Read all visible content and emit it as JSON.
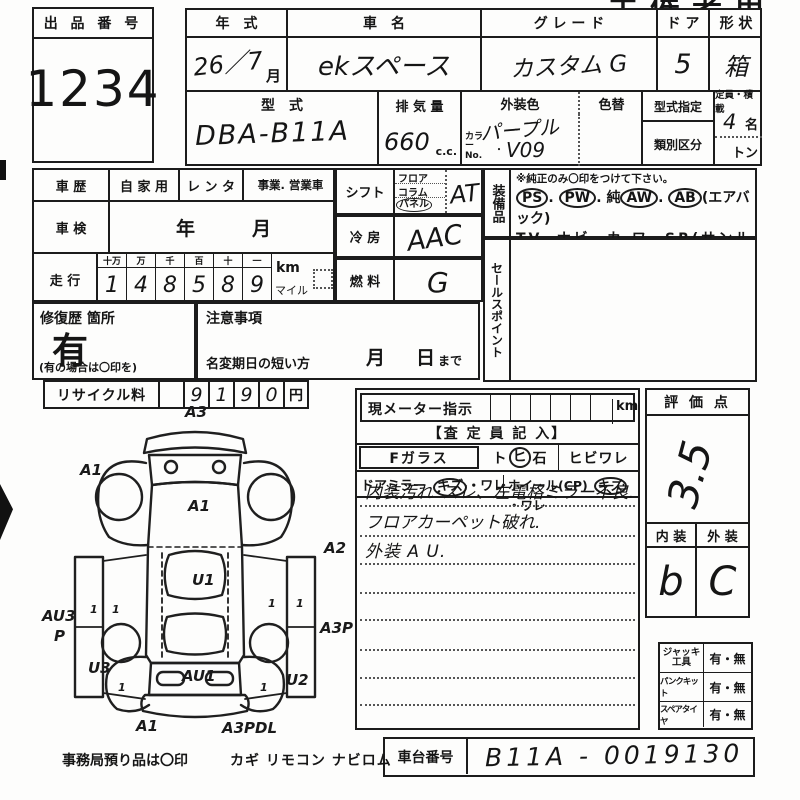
{
  "sheet": {
    "corner_title": "主催者用"
  },
  "auction": {
    "label": "出 品 番 号",
    "number": "1234"
  },
  "vehicle": {
    "year_label": "年　式",
    "year_value": "26／7",
    "month_suffix": "月",
    "name_label": "車　名",
    "name_value": "ekスペース",
    "grade_label": "グ レ ー ド",
    "grade_value": "カスタム G",
    "door_label": "ド ア",
    "door_value": "5",
    "shape_label": "形 状",
    "shape_value": "箱",
    "model_label": "型　式",
    "model_value": "DBA-B11A",
    "disp_label": "排 気 量",
    "disp_value": "660",
    "disp_unit": "c.c.",
    "color_label": "外装色",
    "color_value": "パープル",
    "color_change_label": "色替",
    "color_no_label": "カラーNo.",
    "color_no_dot": "・",
    "color_no_value": "V09",
    "type_desig_label": "型式指定",
    "class_label": "類別区分",
    "capacity_label": "定員・積載",
    "capacity_value": "4",
    "capacity_unit": "名",
    "ton_unit": "トン"
  },
  "history": {
    "label": "車 歴",
    "private": "自 家 用",
    "rental": "レ ン タ",
    "business": "事業. 営業車",
    "inspection_label": "車 検",
    "inspection_value": "年　　　月"
  },
  "mileage": {
    "label": "走 行",
    "digit_headers": [
      "十万",
      "万",
      "千",
      "百",
      "十",
      "一"
    ],
    "digits": [
      "1",
      "4",
      "8",
      "5",
      "8",
      "9"
    ],
    "unit_km": "km",
    "unit_mile": "マイル"
  },
  "repair": {
    "label": "修復歴 箇所",
    "value": "有",
    "note": "(有の場合は〇印を)"
  },
  "caution": {
    "label": "注意事項",
    "rename_label": "名変期日の短い方",
    "month": "月",
    "day": "日",
    "made": "まで"
  },
  "recycle": {
    "label": "リサイクル料",
    "digits": [
      "9",
      "1",
      "9",
      "0"
    ],
    "unit": "円"
  },
  "shift": {
    "label": "シフト",
    "floor": "フロア",
    "column": "コラム",
    "panel": "パネル",
    "value": "AT"
  },
  "ac": {
    "label": "冷 房",
    "value": "AAC"
  },
  "fuel": {
    "label": "燃 料",
    "value": "G"
  },
  "equipment": {
    "label": "装備品",
    "note": "※純正のみ〇印をつけて下さい。",
    "dot": ".",
    "ps": "PS",
    "pw": "PW",
    "aw_prefix": "純",
    "aw": "AW",
    "ab": "AB",
    "ab_note": "(エアバック)",
    "line2": "TV. ナビ. カ ワ. SR(サンルーフ)",
    "line3": "ABS ・ 新車保証書←(注) 後日送りのみ"
  },
  "sales_point": {
    "label": "セールスポイント"
  },
  "meter": {
    "label": "現メーター指示",
    "unit": "km"
  },
  "assessor": {
    "header": "【査 定 員 記 入】",
    "fglass_label": "Fガラス",
    "tobi": "ト",
    "hi": "ヒ",
    "ishi": "石",
    "hibiware": "ヒビワレ",
    "mirror_label": "ドアミラー",
    "mirror_kizu": "キズ",
    "mirror_ware": "・ワレ",
    "wheel_label": "ホイール(CP)",
    "wheel_kizu": "キズ",
    "wheel_ware": "・ワレ",
    "notes": [
      "内装汚れ･スレ、左電格ミラー不良.",
      "フロアカーペット破れ.",
      "外装 A U."
    ]
  },
  "evaluation": {
    "label": "評 価 点",
    "score": "3.5",
    "interior_label": "内 装",
    "exterior_label": "外 装",
    "interior_value": "b",
    "exterior_value": "C"
  },
  "accessories": {
    "rows": [
      {
        "label": "ジャッキ工具",
        "value": "有・無"
      },
      {
        "label": "パンクキット",
        "value": "有・無"
      },
      {
        "label": "スペアタイヤ",
        "value": "有・無"
      }
    ]
  },
  "chassis": {
    "label": "車台番号",
    "value": "B11A - 0019130"
  },
  "office_note": {
    "text": "事務局預り品は〇印",
    "items": "カギ  リモコン  ナビロム"
  },
  "diagram": {
    "labels": [
      "A3",
      "A1",
      "A1",
      "A2",
      "U1",
      "AU3",
      "P",
      "A3P",
      "U3",
      "U2",
      "AU1",
      "A1",
      "A3PDL",
      "1",
      "1",
      "1",
      "1",
      "1",
      "1"
    ]
  }
}
